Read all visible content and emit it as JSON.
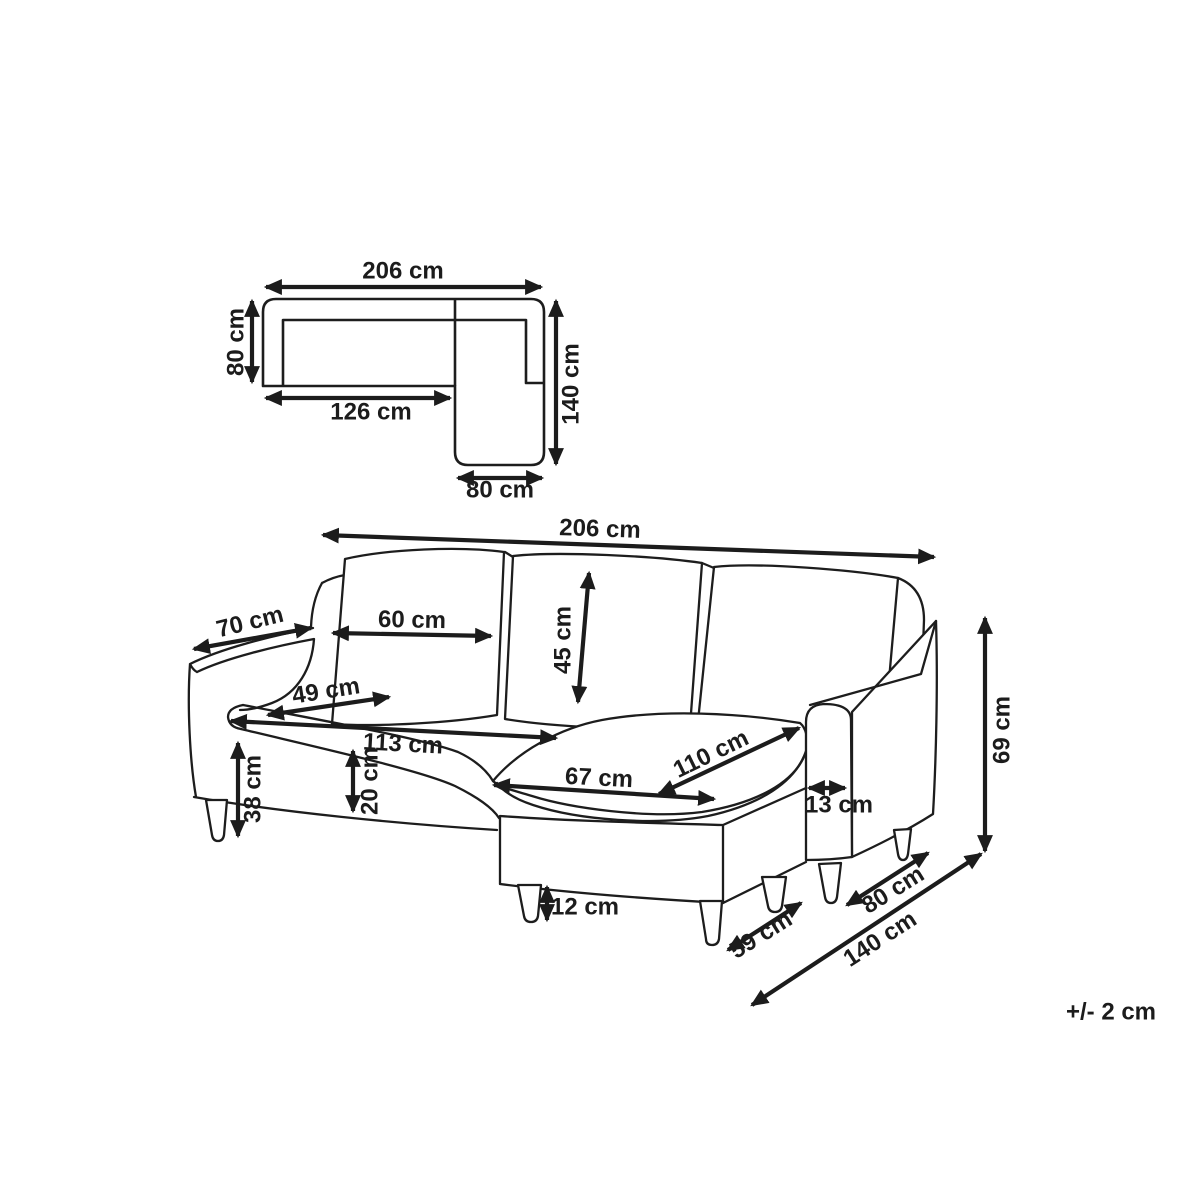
{
  "diagram": {
    "tolerance_note": "+/- 2 cm",
    "plan_view": {
      "total_width": "206 cm",
      "sofa_depth": "80 cm",
      "seat_section_width": "126 cm",
      "chaise_total_depth": "140 cm",
      "chaise_width": "80 cm"
    },
    "perspective_view": {
      "total_width": "206 cm",
      "armrest_depth": "70 cm",
      "back_cushion_width": "60 cm",
      "back_cushion_height": "45 cm",
      "seat_cushion_depth": "49 cm",
      "seat_width": "113 cm",
      "chaise_seat_length": "110 cm",
      "chaise_seat_width": "67 cm",
      "armrest_thickness": "13 cm",
      "seat_height": "38 cm",
      "base_height": "20 cm",
      "leg_height": "12 cm",
      "chaise_front_width": "59 cm",
      "armrest_side_depth": "80 cm",
      "total_depth": "140 cm",
      "armrest_height": "69 cm"
    }
  }
}
